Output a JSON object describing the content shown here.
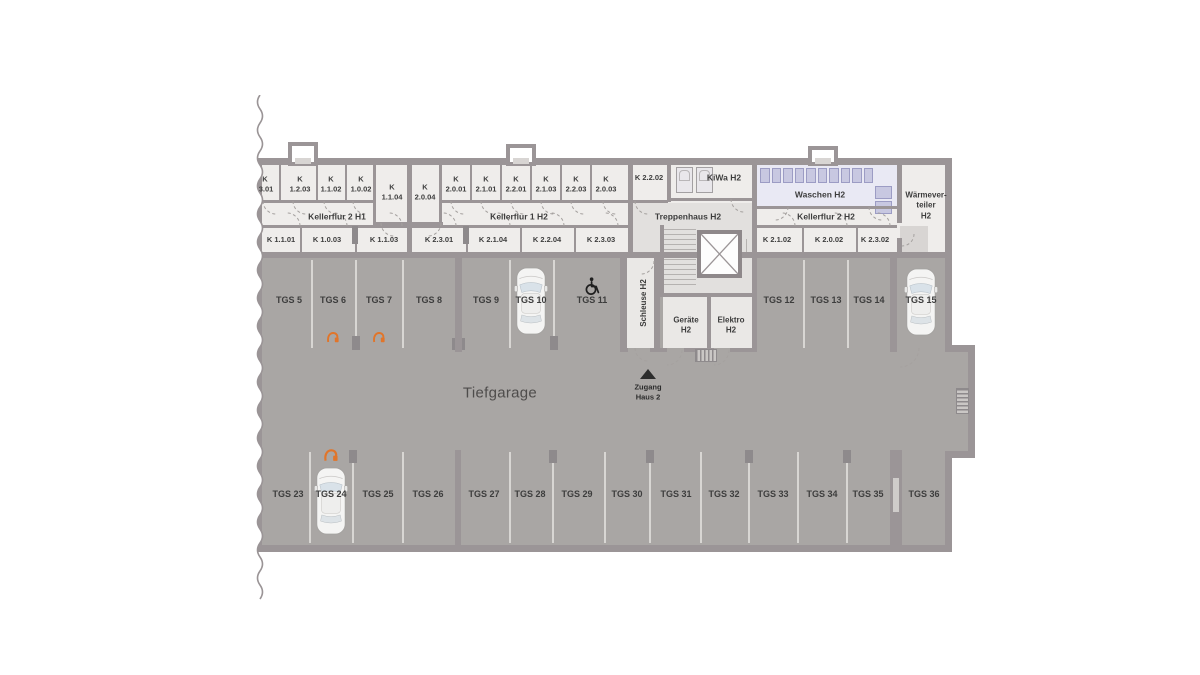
{
  "title": "Tiefgarage Untergeschoss Plan",
  "corridors": {
    "h1": "Kellerflur 2 H1",
    "h2_1": "Kellerflur 1 H2",
    "h2_2": "Kellerflur 2 H2"
  },
  "cellar": {
    "top_left": [
      "K\n.3.01",
      "K\n1.2.03",
      "K\n1.1.02",
      "K\n1.0.02",
      "K\n1.1.04"
    ],
    "top_middle": [
      "K\n2.0.04",
      "K\n2.0.01",
      "K\n2.1.01",
      "K\n2.2.01",
      "K\n2.1.03",
      "K\n2.2.03",
      "K\n2.0.03"
    ],
    "k_2_2_02": "K 2.2.02",
    "bottom_left": [
      "K 1.1.01",
      "K 1.0.03",
      "K 1.1.03"
    ],
    "bottom_middle": [
      "K 2.3.01",
      "K 2.1.04",
      "K 2.2.04",
      "K 2.3.03"
    ],
    "bottom_right": [
      "K 2.1.02",
      "K 2.0.02",
      "K 2.3.02"
    ]
  },
  "rooms": {
    "kiwa": "KiWa H2",
    "waschen": "Waschen H2",
    "waermeverteiler": "Wärmever-\nteiler\nH2",
    "treppenhaus": "Treppenhaus H2",
    "schleuse": "Schleuse H2",
    "geraete": "Geräte\nH2",
    "elektro": "Elektro\nH2"
  },
  "garage": {
    "label": "Tiefgarage",
    "access": "Zugang\nHaus 2"
  },
  "parking": {
    "top": [
      {
        "label": "TGS 5"
      },
      {
        "label": "TGS 6",
        "feature": "ev-charging"
      },
      {
        "label": "TGS 7",
        "feature": "ev-charging"
      },
      {
        "label": "TGS 8"
      },
      {
        "label": "TGS 9"
      },
      {
        "label": "TGS 10",
        "feature": "car-parked"
      },
      {
        "label": "TGS 11",
        "feature": "accessible"
      },
      {
        "label": "TGS 12"
      },
      {
        "label": "TGS 13"
      },
      {
        "label": "TGS 14"
      },
      {
        "label": "TGS 15",
        "feature": "car-parked"
      }
    ],
    "bottom": [
      {
        "label": "TGS 23"
      },
      {
        "label": "TGS 24",
        "feature": "car-parked-ev-charging"
      },
      {
        "label": "TGS 25"
      },
      {
        "label": "TGS 26"
      },
      {
        "label": "TGS 27"
      },
      {
        "label": "TGS 28"
      },
      {
        "label": "TGS 29"
      },
      {
        "label": "TGS 30"
      },
      {
        "label": "TGS 31"
      },
      {
        "label": "TGS 32"
      },
      {
        "label": "TGS 33"
      },
      {
        "label": "TGS 34"
      },
      {
        "label": "TGS 35"
      },
      {
        "label": "TGS 36"
      }
    ]
  },
  "colors": {
    "wall": "#9b9597",
    "garage_floor": "#a9a6a4",
    "cellar_floor": "#efedeb",
    "room_floor": "#eae8e6",
    "stair_floor": "#e2e0de",
    "waschen_floor": "#e9e9f4",
    "washer_unit": "#c8c8e1",
    "ev_orange": "#e1752a",
    "label_text": "#3d3d3d"
  }
}
